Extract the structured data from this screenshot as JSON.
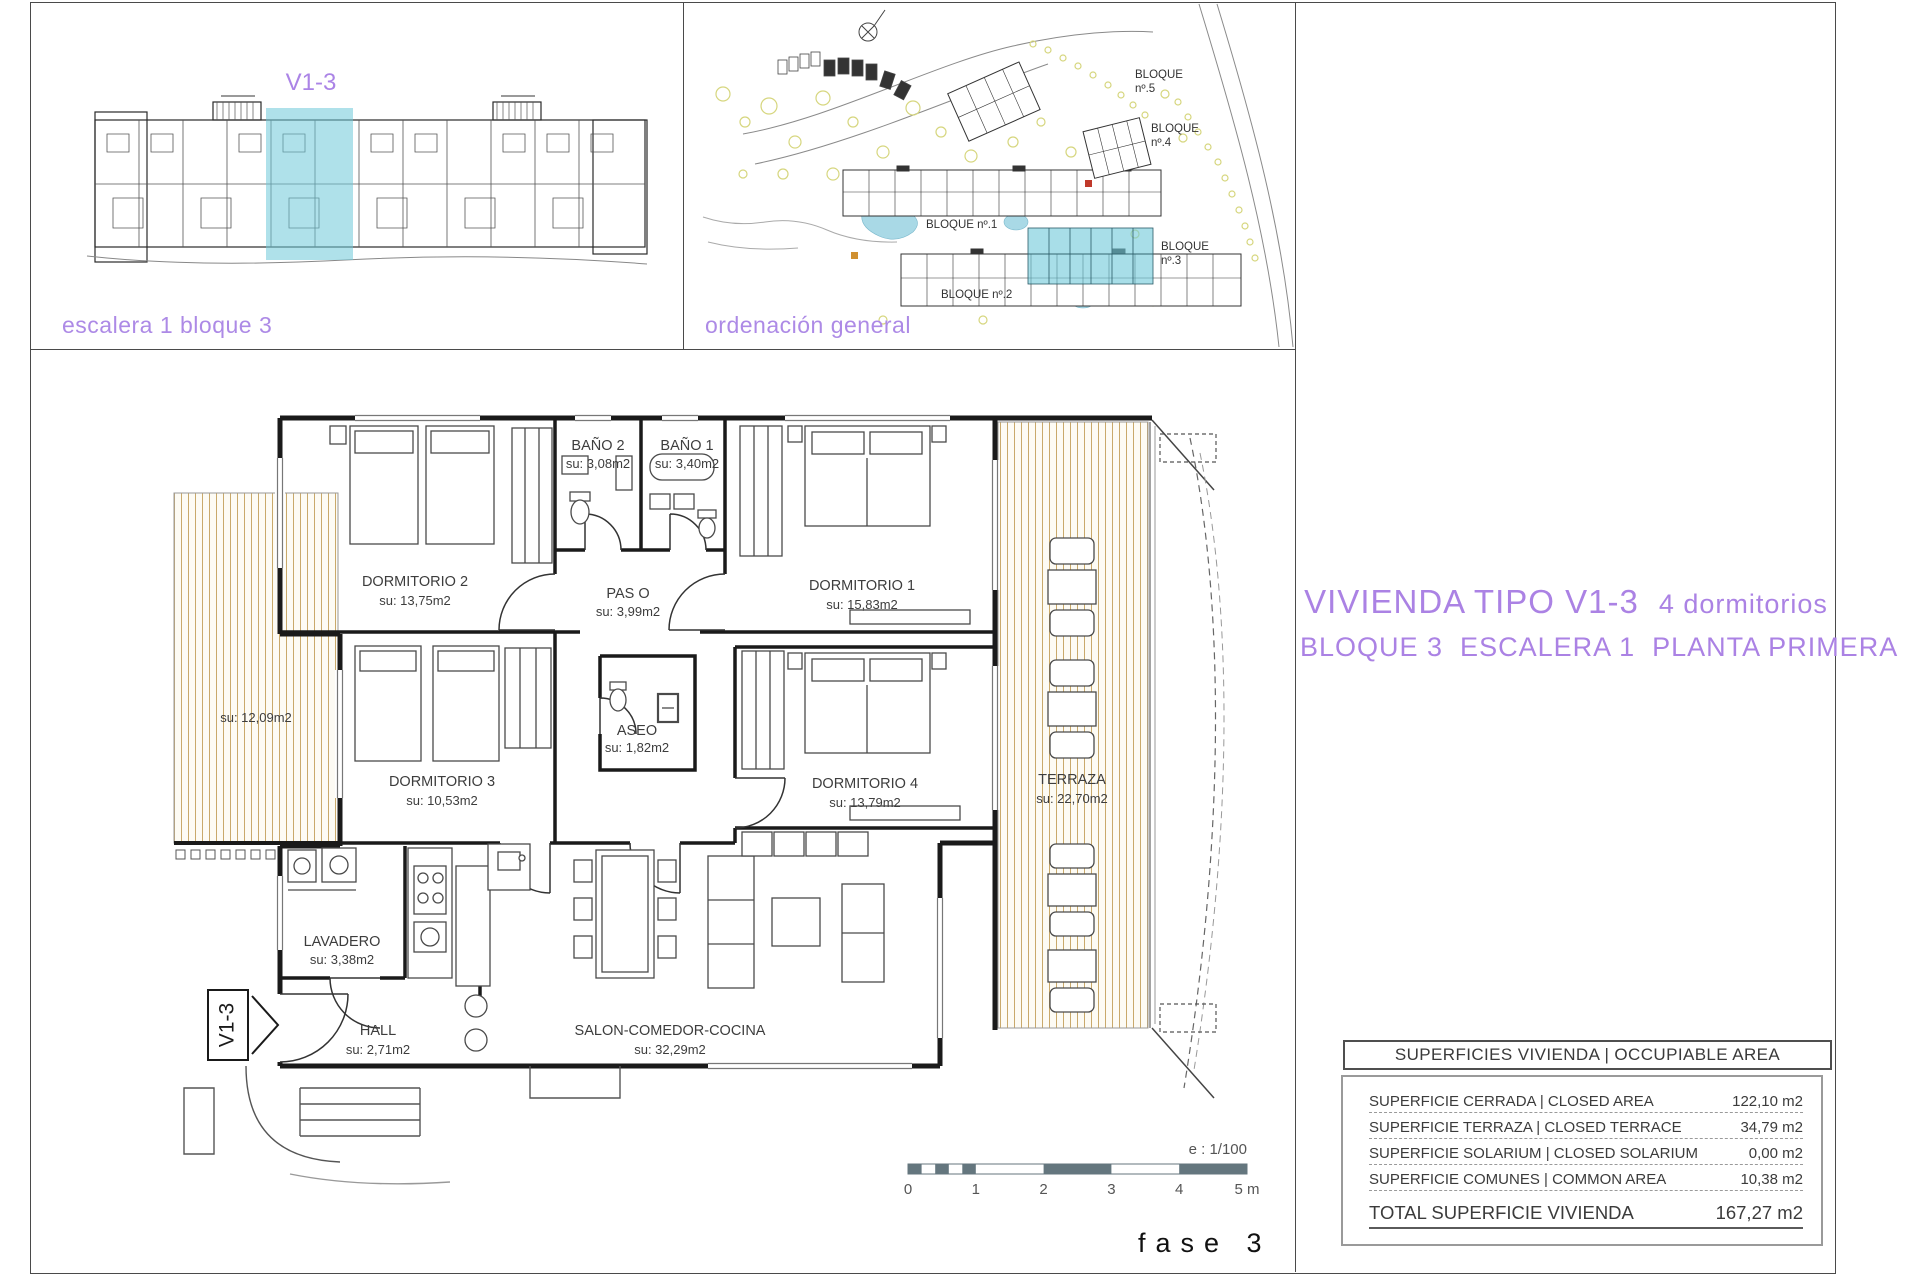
{
  "colors": {
    "accent_purple": "#ab84e6",
    "highlight_cyan": "#6ec8d8",
    "hatch_tan": "#c9a96b",
    "scalebar_gray": "#64767e",
    "pool_blue": "#a9d9e6",
    "tree_green": "#d6d67e"
  },
  "locator_panel": {
    "caption": "escalera 1 bloque 3",
    "unit_label": "V1-3"
  },
  "site_panel": {
    "caption": "ordenación general",
    "blocks": {
      "b1": "BLOQUE nº.1",
      "b2": "BLOQUE nº.2",
      "b3a": "BLOQUE",
      "b3b": "nº.3",
      "b4a": "BLOQUE",
      "b4b": "nº.4",
      "b5a": "BLOQUE",
      "b5b": "nº.5"
    }
  },
  "title_block": {
    "line1_main": "VIVIENDA TIPO V1-3",
    "line1_sub": "4 dormitorios",
    "line2": "BLOQUE 3  ESCALERA 1  PLANTA PRIMERA"
  },
  "floor_plan": {
    "entry_tag": "V1-3",
    "rooms": {
      "dormitorio1": {
        "name": "DORMITORIO 1",
        "area": "su: 15,83m2"
      },
      "dormitorio2": {
        "name": "DORMITORIO 2",
        "area": "su: 13,75m2"
      },
      "dormitorio3": {
        "name": "DORMITORIO 3",
        "area": "su: 10,53m2"
      },
      "dormitorio4": {
        "name": "DORMITORIO 4",
        "area": "su: 13,79m2"
      },
      "bano1": {
        "name": "BAÑO 1",
        "area": "su: 3,40m2"
      },
      "bano2": {
        "name": "BAÑO 2",
        "area": "su: 3,08m2"
      },
      "paso": {
        "name": "PAS O",
        "area": "su: 3,99m2"
      },
      "aseo": {
        "name": "ASEO",
        "area": "su: 1,82m2"
      },
      "lavadero": {
        "name": "LAVADERO",
        "area": "su: 3,38m2"
      },
      "hall": {
        "name": "HALL",
        "area": "su: 2,71m2"
      },
      "salon": {
        "name": "SALON-COMEDOR-COCINA",
        "area": "su: 32,29m2"
      },
      "terraza": {
        "name": "TERRAZA",
        "area": "su: 22,70m2"
      },
      "terraza_izq": {
        "area": "su: 12,09m2"
      }
    }
  },
  "scale_bar": {
    "label": "e : 1/100",
    "ticks": [
      "0",
      "1",
      "2",
      "3",
      "4",
      "5 m"
    ]
  },
  "footer": {
    "phase": "fase 3"
  },
  "areas_table": {
    "header": "SUPERFICIES VIVIENDA | OCCUPIABLE AREA",
    "rows": [
      {
        "label": "SUPERFICIE CERRADA | CLOSED AREA",
        "value": "122,10 m2"
      },
      {
        "label": "SUPERFICIE TERRAZA | CLOSED TERRACE",
        "value": "34,79 m2"
      },
      {
        "label": "SUPERFICIE SOLARIUM | CLOSED SOLARIUM",
        "value": "0,00 m2"
      },
      {
        "label": "SUPERFICIE COMUNES | COMMON AREA",
        "value": "10,38 m2"
      }
    ],
    "total": {
      "label": "TOTAL SUPERFICIE VIVIENDA",
      "value": "167,27 m2"
    }
  }
}
